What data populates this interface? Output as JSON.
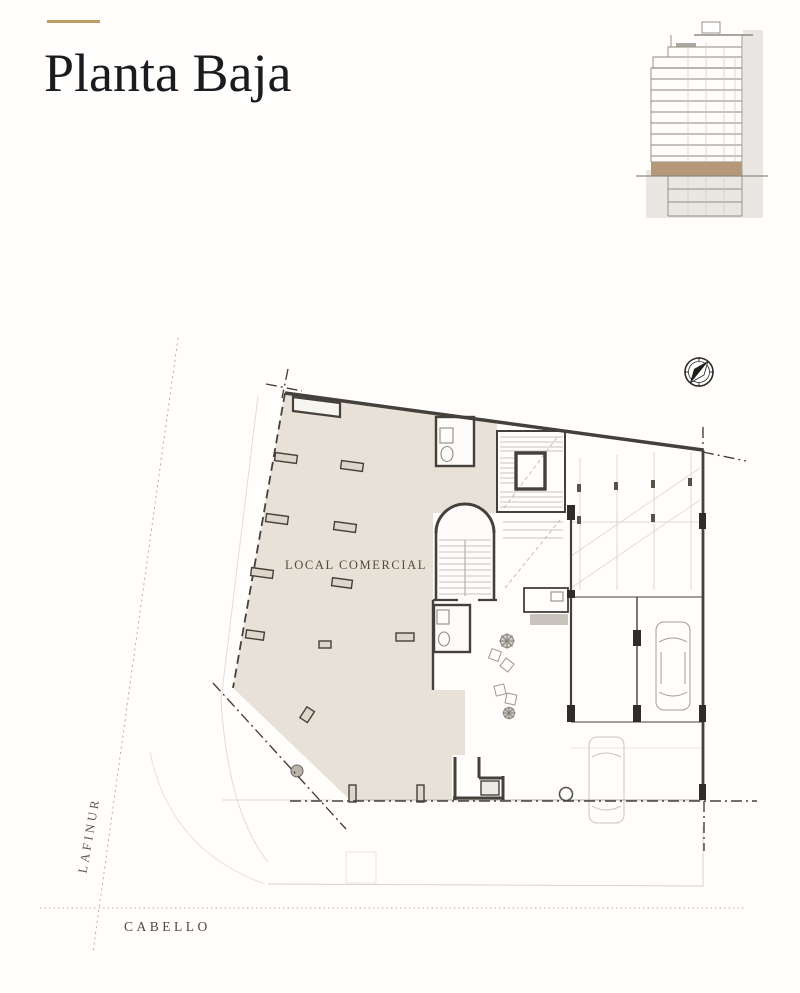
{
  "page": {
    "title": "Planta Baja"
  },
  "plan": {
    "area_label": "LOCAL COMERCIAL",
    "streets": {
      "left": "LAFINUR",
      "bottom": "CABELLO"
    }
  },
  "icons": {
    "compass": "north-compass"
  },
  "colors": {
    "accent_gold": "#bf9d62",
    "plan_shade": "#e8e1d7",
    "elevation_highlight": "#b49877",
    "ink": "#1b1b20"
  }
}
